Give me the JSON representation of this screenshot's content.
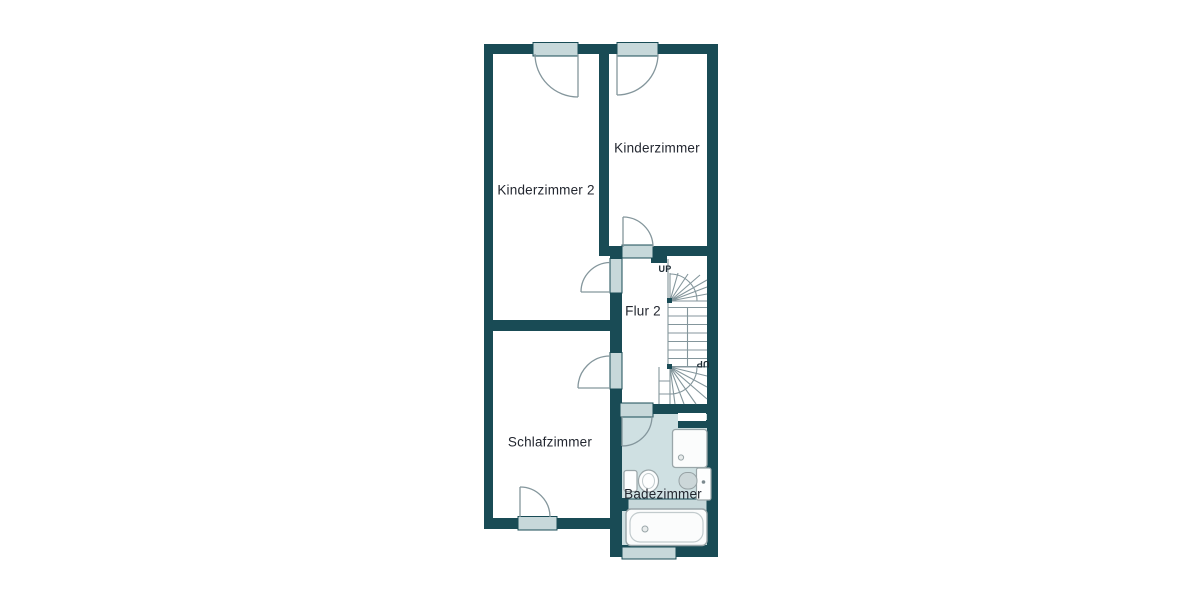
{
  "plan": {
    "type": "floorplan",
    "floor_hint": "upper floor (stairs up and down)",
    "rooms": {
      "kinderzimmer": "Kinderzimmer",
      "kinderzimmer2": "Kinderzimmer 2",
      "flur2": "Flur 2",
      "schlafzimmer": "Schlafzimmer",
      "badezimmer": "Badezimmer"
    },
    "stairs": {
      "up_top": "UP",
      "up_bottom": "UP"
    },
    "fixtures": [
      "shower",
      "toilet",
      "sink",
      "bathtub"
    ]
  },
  "colors": {
    "wall": "#194b55",
    "window_fill": "#c7d8da",
    "bath_floor": "#cfe0e2",
    "line": "#84969c",
    "text": "#232730"
  }
}
